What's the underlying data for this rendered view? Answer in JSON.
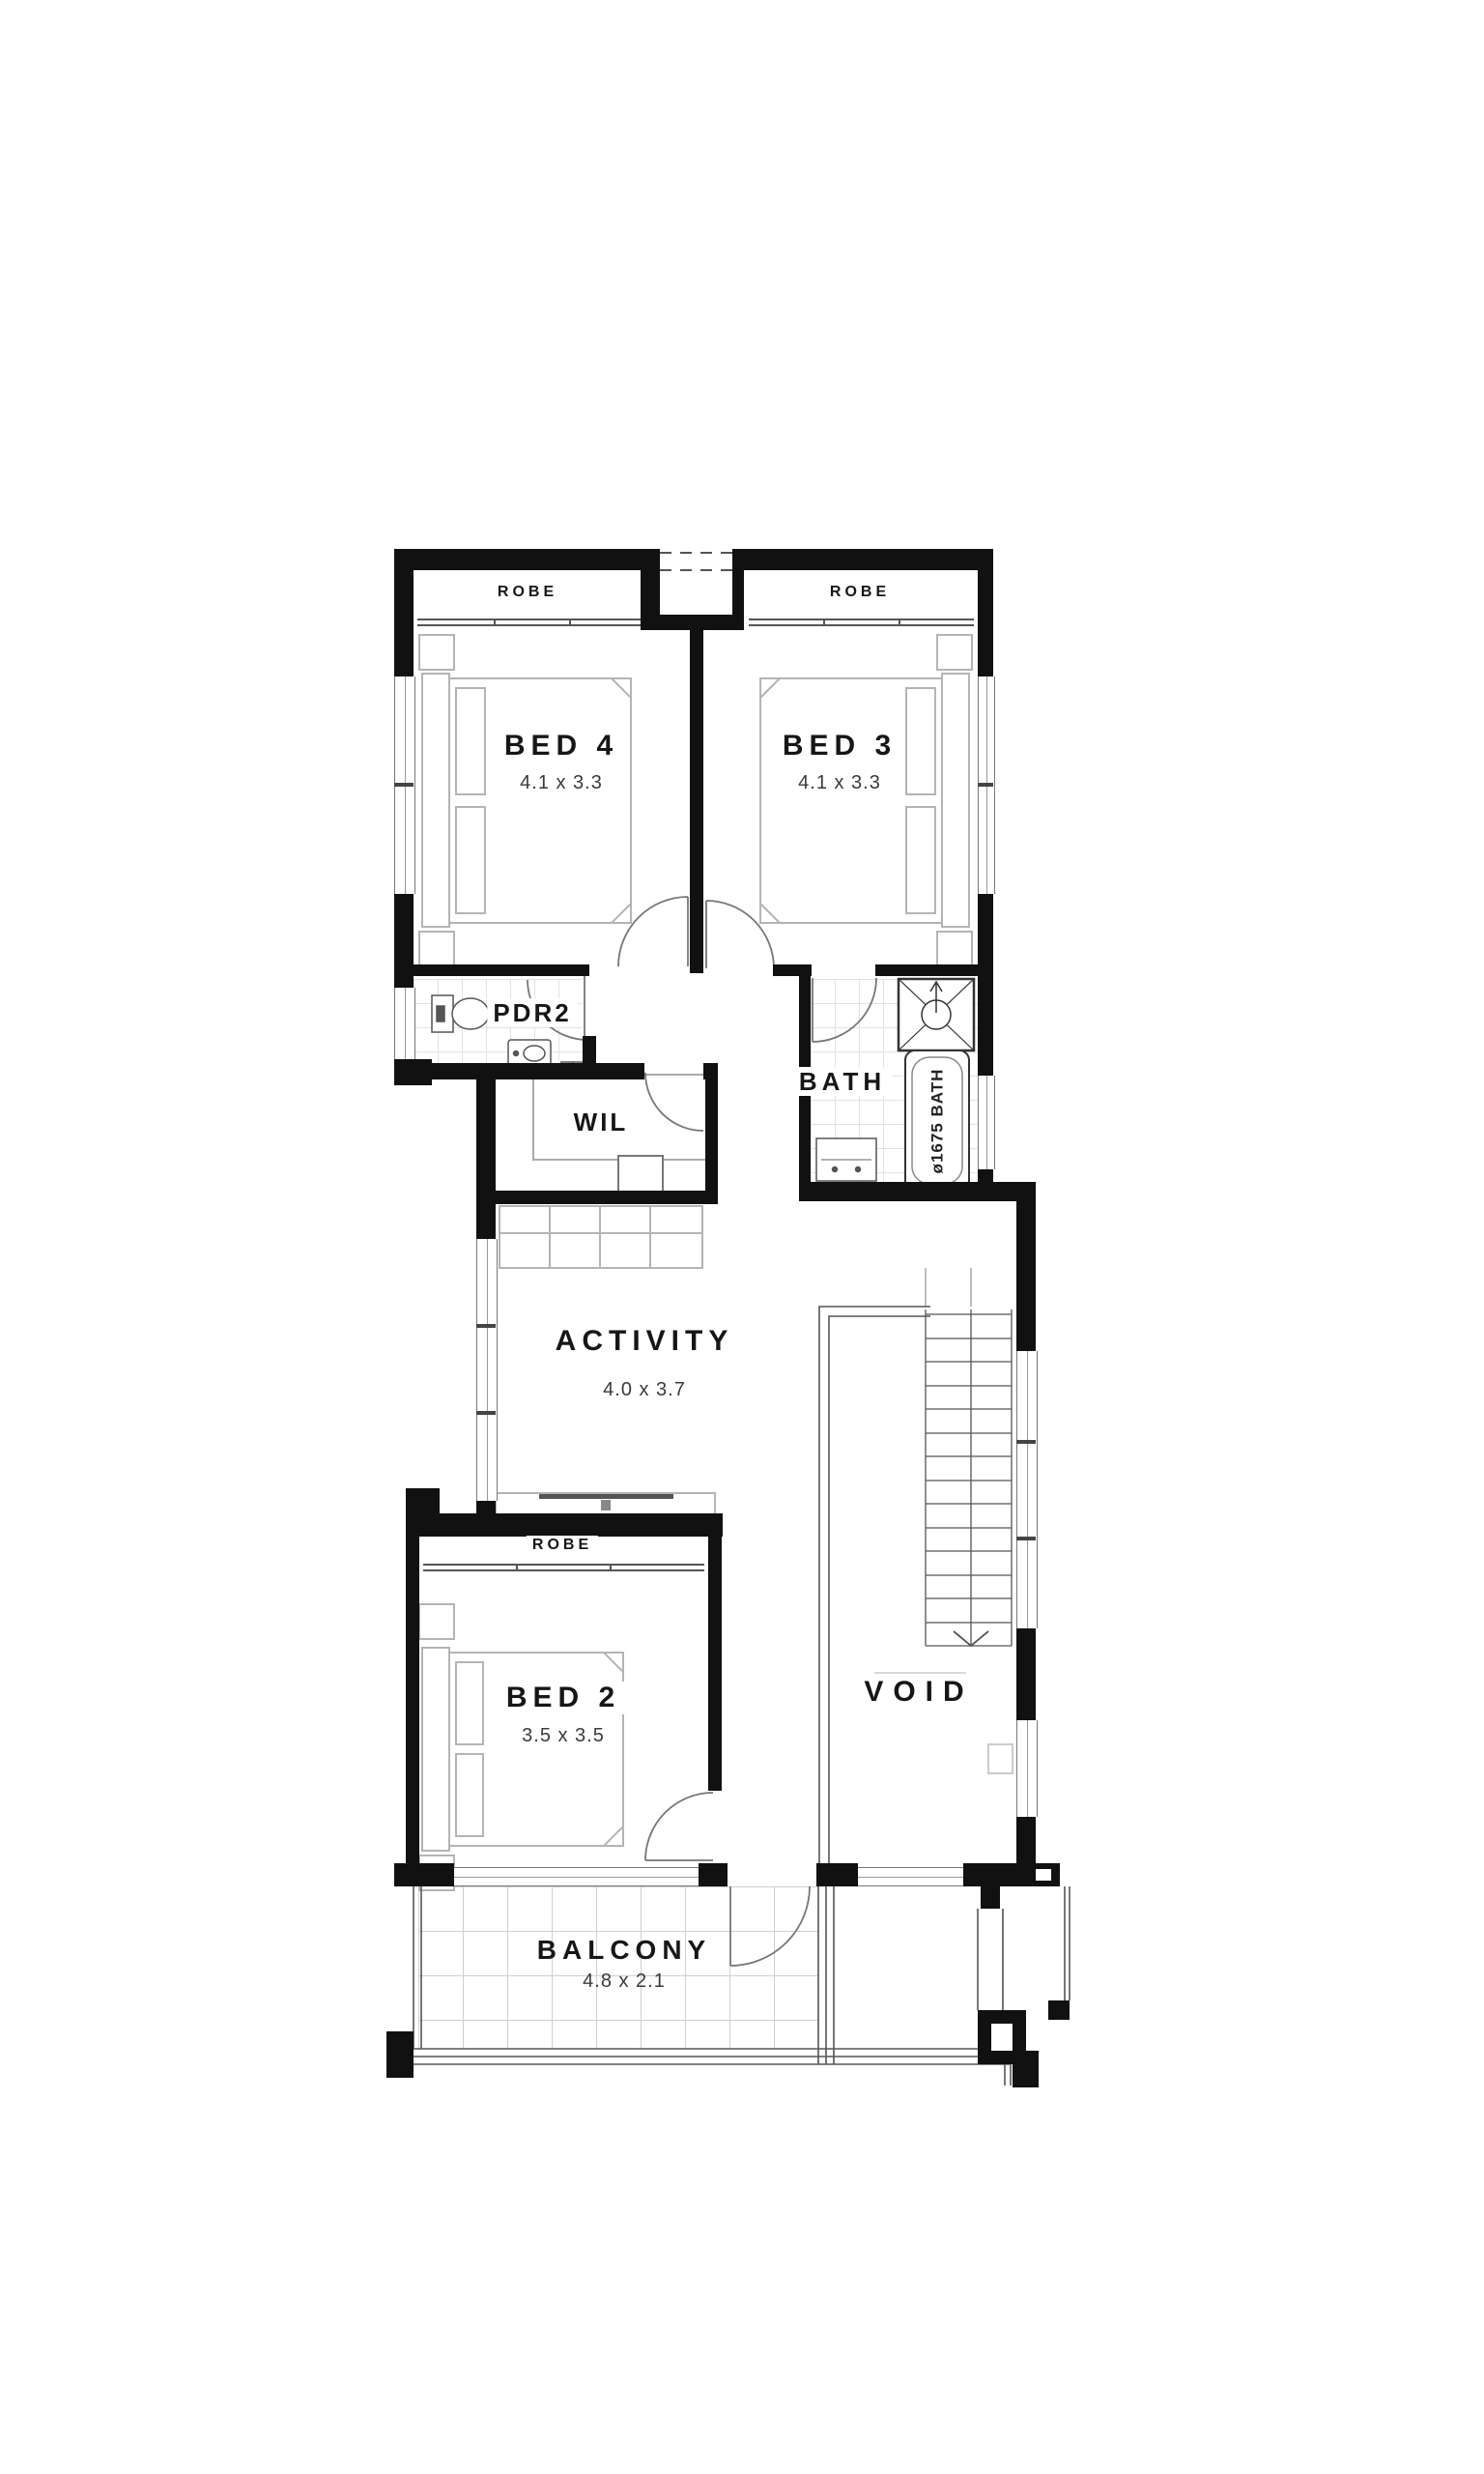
{
  "rooms": {
    "bed4": {
      "label": "BED 4",
      "dims": "4.1 x 3.3",
      "robe_label": "ROBE"
    },
    "bed3": {
      "label": "BED 3",
      "dims": "4.1 x 3.3",
      "robe_label": "ROBE"
    },
    "bed2": {
      "label": "BED 2",
      "dims": "3.5 x 3.5",
      "robe_label": "ROBE"
    },
    "pdr2": {
      "label": "PDR2"
    },
    "wil": {
      "label": "WIL"
    },
    "bath": {
      "label": "BATH",
      "tub_label": "ø1675 BATH"
    },
    "activity": {
      "label": "ACTIVITY",
      "dims": "4.0 x 3.7"
    },
    "void": {
      "label": "VOID"
    },
    "balcony": {
      "label": "BALCONY",
      "dims": "4.8 x 2.1"
    }
  },
  "colors": {
    "wall": "#111111",
    "furniture": "#b4b4b4",
    "tile": "#e2e2e2",
    "line": "#777777"
  }
}
